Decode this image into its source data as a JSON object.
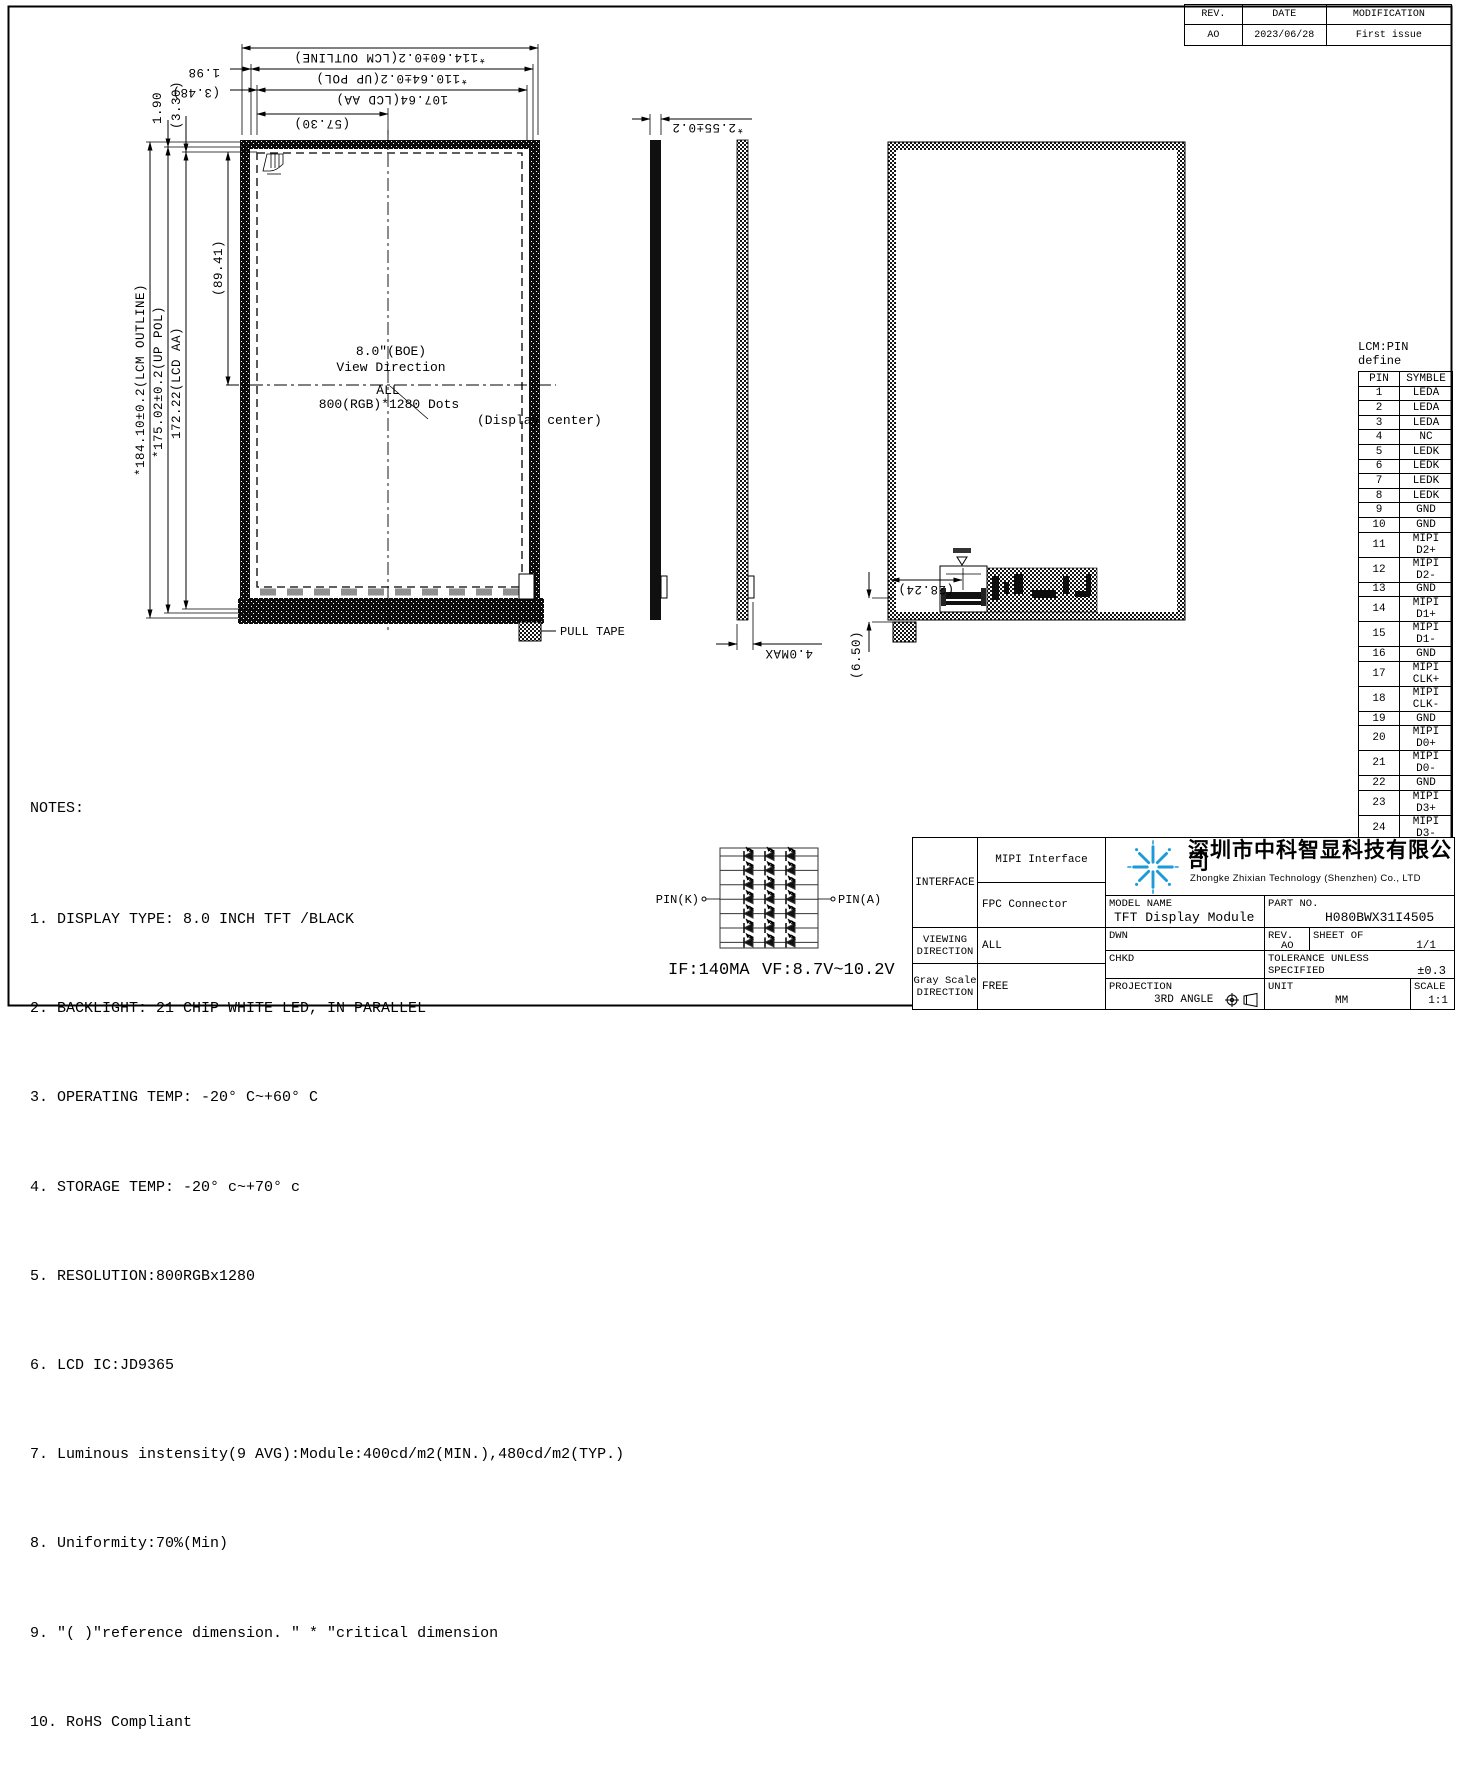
{
  "colors": {
    "line": "#000000",
    "logo_blue": "#1b9bd8",
    "pad_gray": "#8f8f8f"
  },
  "revision_table": {
    "headers": [
      "REV.",
      "DATE",
      "MODIFICATION"
    ],
    "rows": [
      [
        "AO",
        "2023/06/28",
        "First issue"
      ]
    ]
  },
  "front_view": {
    "dims": {
      "outline_w": "*114.60±0.2(LCM OUTLINE)",
      "pol_w": "*110.64±0.2(UP POL)",
      "aa_w": "107.64(LCD AA)",
      "half_w": "(57.30)",
      "d198": "1.98",
      "d348": "(3.48)",
      "d190": "1.90",
      "d330": "(3.30)",
      "outline_h": "*184.10±0.2(LCM OUTLINE)",
      "pol_h": "*175.02±0.2(UP POL)",
      "aa_h": "172.22(LCD AA)",
      "half_h": "(89.41)"
    },
    "center": {
      "size": "8.0″(BOE)",
      "view": "View Direction",
      "all": "ALL",
      "dots": "800(RGB)*1280 Dots",
      "display_center": "(Display center)"
    },
    "pull_tape": "PULL TAPE"
  },
  "side_view": {
    "thickness": "*2.55±0.2",
    "max_thickness": "4.0MAX"
  },
  "back_view": {
    "connector_w": "(28.24)",
    "tail_h": "(6.50)"
  },
  "led_circuit": {
    "pin_k": "PIN(K)",
    "pin_a": "PIN(A)",
    "current": "IF:140MA",
    "voltage": "VF:8.7V~10.2V"
  },
  "notes": {
    "title": "NOTES:",
    "items": [
      "1. DISPLAY TYPE: 8.0 INCH TFT /BLACK",
      "2. BACKLIGHT: 21 CHIP WHITE LED, IN PARALLEL",
      "3. OPERATING TEMP: -20° C~+60° C",
      "4. STORAGE TEMP: -20° c~+70° c",
      "5. RESOLUTION:800RGBx1280",
      "6. LCD IC:JD9365",
      "7. Luminous instensity(9 AVG):Module:400cd/m2(MIN.),480cd/m2(TYP.)",
      "8. Uniformity:70%(Min)",
      "9. ″( )″reference dimension. ″ * ″critical dimension",
      "10. RoHS Compliant"
    ]
  },
  "pin_table": {
    "title": "LCM:PIN define",
    "col_pin": "PIN",
    "col_symbol": "SYMBLE",
    "rows": [
      {
        "pin": "1",
        "symbol": "LEDA"
      },
      {
        "pin": "2",
        "symbol": "LEDA"
      },
      {
        "pin": "3",
        "symbol": "LEDA"
      },
      {
        "pin": "4",
        "symbol": "NC"
      },
      {
        "pin": "5",
        "symbol": "LEDK"
      },
      {
        "pin": "6",
        "symbol": "LEDK"
      },
      {
        "pin": "7",
        "symbol": "LEDK"
      },
      {
        "pin": "8",
        "symbol": "LEDK"
      },
      {
        "pin": "9",
        "symbol": "GND"
      },
      {
        "pin": "10",
        "symbol": "GND"
      },
      {
        "pin": "11",
        "symbol": "MIPI D2+"
      },
      {
        "pin": "12",
        "symbol": "MIPI D2-"
      },
      {
        "pin": "13",
        "symbol": "GND"
      },
      {
        "pin": "14",
        "symbol": "MIPI D1+"
      },
      {
        "pin": "15",
        "symbol": "MIPI D1-"
      },
      {
        "pin": "16",
        "symbol": "GND"
      },
      {
        "pin": "17",
        "symbol": "MIPI CLK+"
      },
      {
        "pin": "18",
        "symbol": "MIPI CLK-"
      },
      {
        "pin": "19",
        "symbol": "GND"
      },
      {
        "pin": "20",
        "symbol": "MIPI D0+"
      },
      {
        "pin": "21",
        "symbol": "MIPI D0-"
      },
      {
        "pin": "22",
        "symbol": "GND"
      },
      {
        "pin": "23",
        "symbol": "MIPI D3+"
      },
      {
        "pin": "24",
        "symbol": "MIPI D3-"
      },
      {
        "pin": "25",
        "symbol": "GND"
      },
      {
        "pin": "26",
        "symbol": "NC"
      },
      {
        "pin": "27",
        "symbol": "RESET"
      },
      {
        "pin": "28",
        "symbol": "NC"
      },
      {
        "pin": "29",
        "symbol": "VDD1V8"
      },
      {
        "pin": "30",
        "symbol": "VDD3V3"
      },
      {
        "pin": "31",
        "symbol": "VDD3V3"
      }
    ]
  },
  "title_block": {
    "interface_label": "INTERFACE",
    "interface_row1": "MIPI Interface",
    "interface_row2": "FPC Connector",
    "company_cn": "深圳市中科智显科技有限公司",
    "company_en": "Zhongke Zhixian Technology (Shenzhen) Co., LTD",
    "model_label": "MODEL NAME",
    "model_value": "TFT Display Module",
    "part_label": "PART NO.",
    "part_value": "H080BWX31I4505",
    "dwn_label": "DWN",
    "chkd_label": "CHKD",
    "projection_label": "PROJECTION",
    "projection_value": "3RD ANGLE",
    "rev_label": "REV.",
    "rev_value": "AO",
    "sheet_label": "SHEET OF",
    "sheet_value": "1/1",
    "tol_label": "TOLERANCE UNLESS SPECIFIED",
    "tol_value": "±0.3",
    "unit_label": "UNIT",
    "unit_value": "MM",
    "scale_label": "SCALE",
    "scale_value": "1:1",
    "viewing_label": "VIEWING DIRECTION",
    "viewing_value": "ALL",
    "gray_label": "Gray Scale DIRECTION",
    "gray_value": "FREE"
  }
}
